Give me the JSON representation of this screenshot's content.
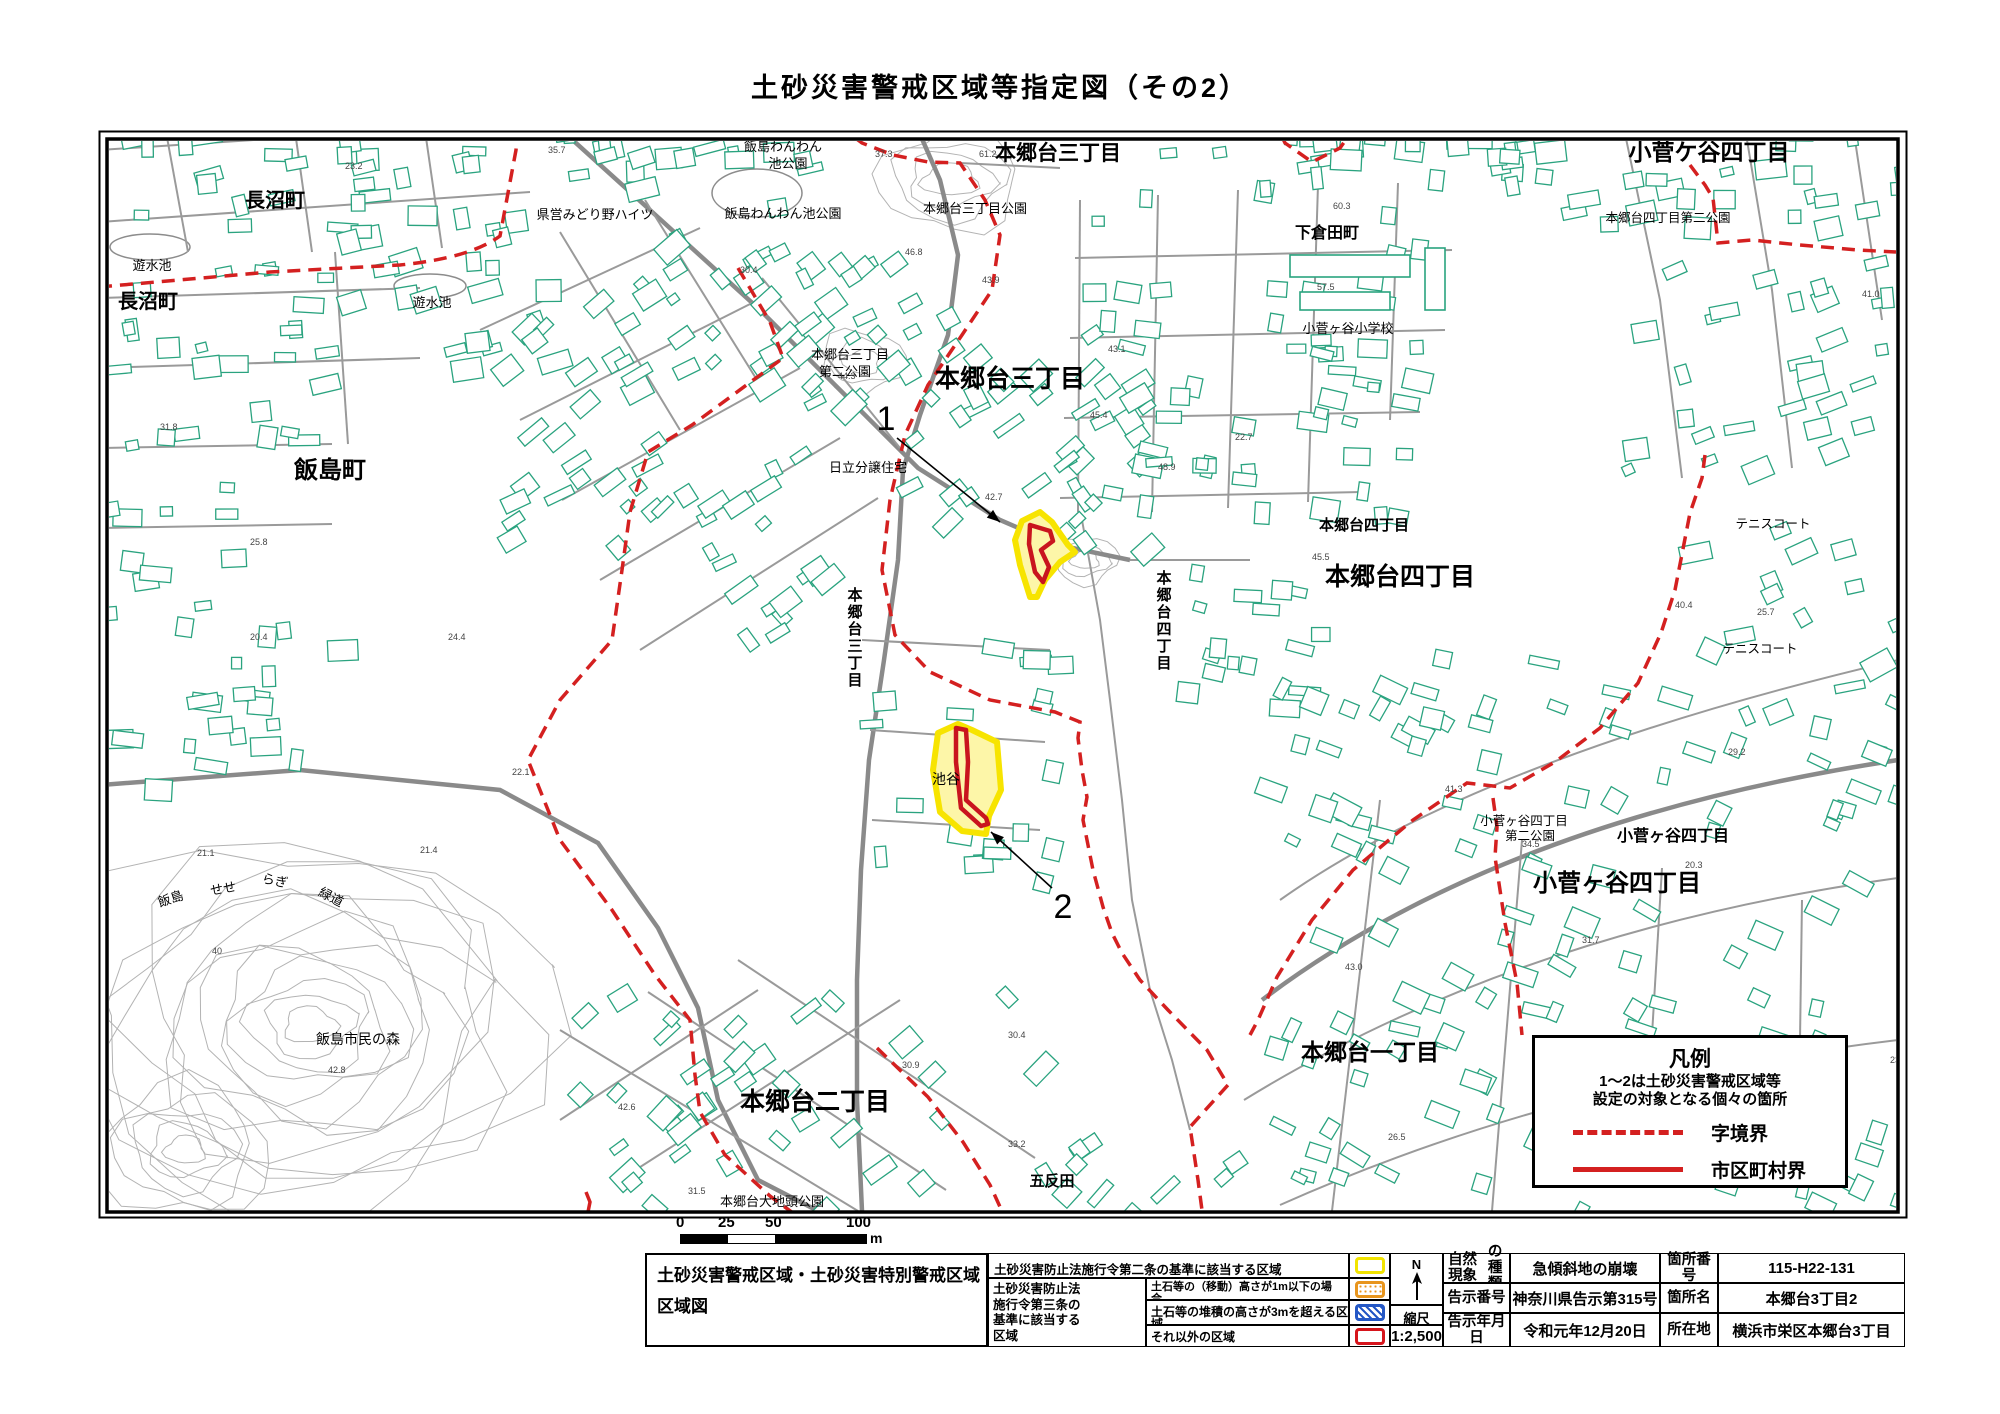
{
  "title": "土砂災害警戒区域等指定図（その2）",
  "colors": {
    "building": "#2aa37f",
    "road": "#9a9a9a",
    "contour": "#b3b3b3",
    "boundary_red": "#d42020",
    "zone_yellow_fill": "#fdf6a8",
    "zone_yellow_edge": "#f7e400",
    "zone_red": "#c9151e",
    "swatch_yellow": "#f2e400",
    "swatch_orange": "#e8951d",
    "swatch_blue": "#2457c5",
    "swatch_red": "#d6151c"
  },
  "map": {
    "labels": [
      {
        "t": "長沼町",
        "x": 275,
        "y": 207,
        "s": 20,
        "b": 1
      },
      {
        "t": "長沼町",
        "x": 148,
        "y": 308,
        "s": 20,
        "b": 1
      },
      {
        "t": "遊水池",
        "x": 152,
        "y": 270,
        "s": 13
      },
      {
        "t": "遊水池",
        "x": 432,
        "y": 307,
        "s": 13
      },
      {
        "t": "県営みどり野ハイツ",
        "x": 595,
        "y": 219,
        "s": 13
      },
      {
        "t": "飯島わんわん",
        "x": 783,
        "y": 151,
        "s": 13
      },
      {
        "t": "池公園",
        "x": 788,
        "y": 168,
        "s": 13
      },
      {
        "t": "飯島わんわん池公園",
        "x": 783,
        "y": 218,
        "s": 13
      },
      {
        "t": "本郷台三丁目",
        "x": 1058,
        "y": 160,
        "s": 21,
        "b": 1
      },
      {
        "t": "本郷台三丁目公園",
        "x": 975,
        "y": 213,
        "s": 13
      },
      {
        "t": "小菅ケ谷四丁目",
        "x": 1709,
        "y": 160,
        "s": 23,
        "b": 1
      },
      {
        "t": "下倉田町",
        "x": 1327,
        "y": 238,
        "s": 16,
        "b": 1
      },
      {
        "t": "本郷台四丁目第二公園",
        "x": 1668,
        "y": 222,
        "s": 12.5
      },
      {
        "t": "小菅ヶ谷小学校",
        "x": 1348,
        "y": 333,
        "s": 13
      },
      {
        "t": "本郷台三丁目",
        "x": 850,
        "y": 359,
        "s": 13
      },
      {
        "t": "第二公園",
        "x": 845,
        "y": 376,
        "s": 13
      },
      {
        "t": "本郷台三丁目",
        "x": 1010,
        "y": 387,
        "s": 25,
        "b": 1
      },
      {
        "t": "日立分譲住宅",
        "x": 868,
        "y": 472,
        "s": 13
      },
      {
        "t": "本郷台三丁目",
        "x": 855,
        "y": 600,
        "s": 15,
        "b": 1,
        "v": 1
      },
      {
        "t": "本郷台四丁目",
        "x": 1164,
        "y": 583,
        "s": 15,
        "b": 1,
        "v": 1
      },
      {
        "t": "本郷台四丁目",
        "x": 1364,
        "y": 530,
        "s": 15,
        "b": 1
      },
      {
        "t": "本郷台四丁目",
        "x": 1400,
        "y": 585,
        "s": 25,
        "b": 1
      },
      {
        "t": "テニスコート",
        "x": 1773,
        "y": 528,
        "s": 12.5
      },
      {
        "t": "テニスコート",
        "x": 1760,
        "y": 653,
        "s": 12.5
      },
      {
        "t": "池谷",
        "x": 946,
        "y": 784,
        "s": 14
      },
      {
        "t": "小菅ヶ谷四丁目",
        "x": 1524,
        "y": 825,
        "s": 12.5
      },
      {
        "t": "第二公園",
        "x": 1530,
        "y": 840,
        "s": 12.5
      },
      {
        "t": "小菅ヶ谷四丁目",
        "x": 1673,
        "y": 841,
        "s": 16,
        "b": 1
      },
      {
        "t": "小菅ヶ谷四丁目",
        "x": 1617,
        "y": 891,
        "s": 24,
        "b": 1
      },
      {
        "t": "飯島町",
        "x": 330,
        "y": 478,
        "s": 24,
        "b": 1
      },
      {
        "t": "飯島",
        "x": 172,
        "y": 903,
        "s": 13,
        "r": -18
      },
      {
        "t": "せせ",
        "x": 224,
        "y": 893,
        "s": 13,
        "r": -10
      },
      {
        "t": "らぎ",
        "x": 274,
        "y": 885,
        "s": 13,
        "r": 12
      },
      {
        "t": "緑道",
        "x": 329,
        "y": 901,
        "s": 13,
        "r": 28
      },
      {
        "t": "飯島市民の森",
        "x": 358,
        "y": 1044,
        "s": 14
      },
      {
        "t": "本郷台二丁目",
        "x": 815,
        "y": 1110,
        "s": 25,
        "b": 1
      },
      {
        "t": "本郷台大地頭公園",
        "x": 772,
        "y": 1206,
        "s": 13
      },
      {
        "t": "五反田",
        "x": 1052,
        "y": 1186,
        "s": 15,
        "b": 1
      },
      {
        "t": "本郷台一丁目",
        "x": 1370,
        "y": 1060,
        "s": 23,
        "b": 1
      }
    ],
    "elevations": [
      {
        "v": "23.2",
        "x": 345,
        "y": 169
      },
      {
        "v": "35.7",
        "x": 548,
        "y": 153
      },
      {
        "v": "37.3",
        "x": 875,
        "y": 157
      },
      {
        "v": "61.2",
        "x": 979,
        "y": 157
      },
      {
        "v": "60.3",
        "x": 1333,
        "y": 209
      },
      {
        "v": "57.5",
        "x": 1317,
        "y": 290
      },
      {
        "v": "30.4",
        "x": 740,
        "y": 273
      },
      {
        "v": "43.9",
        "x": 982,
        "y": 283
      },
      {
        "v": "44.3",
        "x": 838,
        "y": 379
      },
      {
        "v": "42.7",
        "x": 985,
        "y": 500
      },
      {
        "v": "45.4",
        "x": 1090,
        "y": 418
      },
      {
        "v": "48.9",
        "x": 1158,
        "y": 470
      },
      {
        "v": "45.5",
        "x": 1312,
        "y": 560
      },
      {
        "v": "40.4",
        "x": 1675,
        "y": 608
      },
      {
        "v": "25.7",
        "x": 1757,
        "y": 615
      },
      {
        "v": "21.1",
        "x": 197,
        "y": 856
      },
      {
        "v": "21.4",
        "x": 420,
        "y": 853
      },
      {
        "v": "40",
        "x": 212,
        "y": 954
      },
      {
        "v": "50.9",
        "x": 92,
        "y": 923
      },
      {
        "v": "42.8",
        "x": 328,
        "y": 1073
      },
      {
        "v": "42.6",
        "x": 618,
        "y": 1110
      },
      {
        "v": "31.5",
        "x": 688,
        "y": 1194
      },
      {
        "v": "33.2",
        "x": 1008,
        "y": 1147
      },
      {
        "v": "30.9",
        "x": 902,
        "y": 1068
      },
      {
        "v": "41.3",
        "x": 1445,
        "y": 792
      },
      {
        "v": "34.5",
        "x": 1522,
        "y": 847
      },
      {
        "v": "20.3",
        "x": 1685,
        "y": 868
      },
      {
        "v": "31.7",
        "x": 1582,
        "y": 943
      },
      {
        "v": "43.0",
        "x": 1345,
        "y": 970
      },
      {
        "v": "30.4",
        "x": 1008,
        "y": 1038
      },
      {
        "v": "25.8",
        "x": 250,
        "y": 545
      },
      {
        "v": "31.8",
        "x": 160,
        "y": 430
      },
      {
        "v": "20.4",
        "x": 250,
        "y": 640
      },
      {
        "v": "24.4",
        "x": 448,
        "y": 640
      },
      {
        "v": "22.1",
        "x": 512,
        "y": 775
      },
      {
        "v": "46.8",
        "x": 905,
        "y": 255
      },
      {
        "v": "22.7",
        "x": 1235,
        "y": 440
      },
      {
        "v": "43.1",
        "x": 1108,
        "y": 352
      },
      {
        "v": "41.0",
        "x": 1862,
        "y": 297
      },
      {
        "v": "29.2",
        "x": 1728,
        "y": 755
      },
      {
        "v": "23.3",
        "x": 1890,
        "y": 1063
      },
      {
        "v": "26.5",
        "x": 1388,
        "y": 1140
      }
    ],
    "markers": [
      {
        "label": "1",
        "x": 886,
        "y": 430,
        "arrow": {
          "x1": 897,
          "y1": 438,
          "x2": 1000,
          "y2": 522
        }
      },
      {
        "label": "2",
        "x": 1063,
        "y": 918,
        "arrow": {
          "x1": 1052,
          "y1": 888,
          "x2": 991,
          "y2": 832
        }
      }
    ],
    "legend_box": {
      "title": "凡例",
      "note_lines": [
        "1～2は土砂災害警戒区域等",
        "設定の対象となる個々の箇所"
      ],
      "entries": [
        {
          "style": "dashed",
          "label": "字境界"
        },
        {
          "style": "solid",
          "label": "市区町村界"
        }
      ]
    },
    "scale_bar": {
      "ticks": [
        "0",
        "25",
        "50",
        "100"
      ],
      "unit": "m"
    }
  },
  "info_table": {
    "map_title_lines": [
      "土砂災害警戒区域・土砂災害特別警戒区域",
      "区域図"
    ],
    "zone_legend": {
      "row1_label": "土砂災害防止法施行令第二条の基準に該当する区域",
      "group_label_lines": [
        "土砂災害防止法",
        "施行令第三条の",
        "基準に該当する",
        "区域"
      ],
      "rows": [
        {
          "lines": [
            "土石等の（移動）高さが1m以下の場合、",
            "土石等の移動による力が100kN/㎡を超える区域"
          ],
          "swatch": "orange"
        },
        {
          "lines": [
            "土石等の堆積の高さが3mを超える区域"
          ],
          "swatch": "blue"
        },
        {
          "lines": [
            "それ以外の区域"
          ],
          "swatch": "red"
        }
      ]
    },
    "compass": {
      "n": "N",
      "scale_label": "縮尺",
      "scale_value": "1:2,500"
    },
    "details": {
      "rows": [
        {
          "k1_lines": [
            "自然現象",
            "の種類"
          ],
          "v1": "急傾斜地の崩壊",
          "k2": "箇所番号",
          "v2": "115-H22-131"
        },
        {
          "k1_lines": [
            "告示番号"
          ],
          "v1": "神奈川県告示第315号",
          "k2": "箇所名",
          "v2": "本郷台3丁目2"
        },
        {
          "k1_lines": [
            "告示年月日"
          ],
          "v1": "令和元年12月20日",
          "k2": "所在地",
          "v2": "横浜市栄区本郷台3丁目"
        }
      ]
    }
  }
}
